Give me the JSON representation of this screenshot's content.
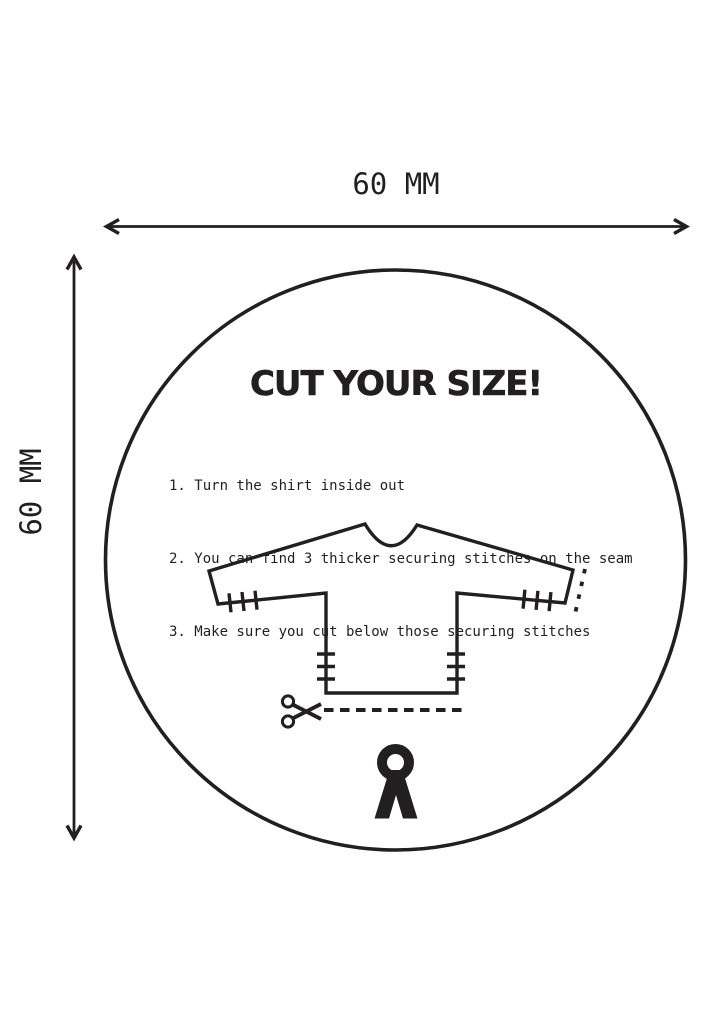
{
  "page": {
    "background": "#ffffff",
    "ink_color": "#221f20"
  },
  "dimensions": {
    "width_label": "60 MM",
    "height_label": "60 MM"
  },
  "sticker": {
    "title": "CUT YOUR SIZE!",
    "steps": [
      "1. Turn the shirt inside out",
      "2. You can find 3 thicker securing stitches on the seam",
      "3. Make sure you cut below those securing stitches"
    ],
    "illustration": {
      "subject": "long-sleeve shirt turned inside out",
      "marks": [
        "3 securing stitches on left sleeve seam",
        "3 securing stitches on right sleeve seam",
        "3 securing stitches on left body seam",
        "3 securing stitches on right body seam",
        "dashed cut line at right cuff",
        "dashed cut line along bottom hem with scissors"
      ]
    },
    "icons": {
      "scissors": "scissors-icon",
      "logo": "brand-logo-a-ring"
    }
  }
}
